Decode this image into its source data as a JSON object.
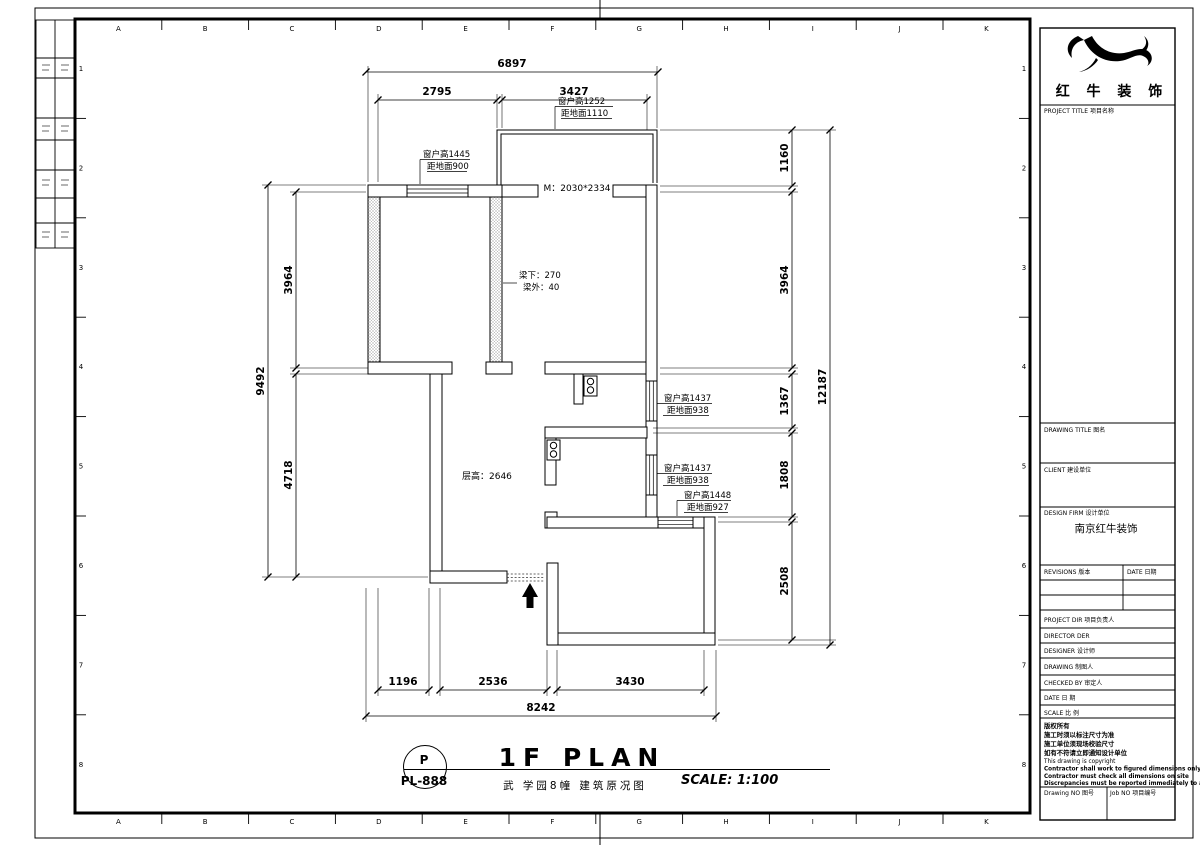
{
  "sheet": {
    "grid": {
      "columns": [
        "A",
        "B",
        "C",
        "D",
        "E",
        "F",
        "G",
        "H",
        "I",
        "J",
        "K"
      ],
      "rows": [
        "1",
        "2",
        "3",
        "4",
        "5",
        "6",
        "7",
        "8"
      ]
    }
  },
  "plan": {
    "dimensions": {
      "top_overall": "6897",
      "top_segments": [
        "2795",
        "3427"
      ],
      "left_overall": "9492",
      "left_segments": [
        "3964",
        "4718"
      ],
      "right_overall": "12187",
      "right_segments": [
        "1160",
        "3964",
        "1367",
        "1808",
        "2508"
      ],
      "bottom_overall": "8242",
      "bottom_segments": [
        "1196",
        "2536",
        "3430"
      ]
    },
    "annotations": {
      "window_left": [
        "窗户高1445",
        "距地面900"
      ],
      "window_top": [
        "窗户高1252",
        "距地面1110"
      ],
      "window_right_upper": [
        "窗户高1437",
        "距地面938"
      ],
      "window_right_lower": [
        "窗户高1437",
        "距地面938"
      ],
      "window_bottom": [
        "窗户高1448",
        "距地面927"
      ],
      "door_size": "M：2030*2334",
      "beam_below": "梁下：270",
      "beam_outside": "梁外：40",
      "ceiling_height": "层高：2646"
    }
  },
  "footer": {
    "code_letter": "P",
    "code_number": "PL-888",
    "title": "1F PLAN",
    "subtitle": "武 学园8幢 建筑原况图",
    "scale_text": "SCALE: 1:100"
  },
  "title_block": {
    "company": "红 牛 装 饰",
    "project_title": "PROJECT TITLE  项目名称",
    "drawing_title": "DRAWING TITLE  图名",
    "client": "CLIENT  建设单位",
    "design_firm": "DESIGN FIRM  设计单位",
    "design_firm_value": "南京红牛装饰",
    "revisions": "REVISIONS  版本",
    "date_col": "DATE  日期",
    "project_dir": "PROJECT DIR  项目负责人",
    "director": "DIRECTOR DER",
    "designer": "DESIGNER  设计师",
    "drawing": "DRAWING  制图人",
    "checked_by": "CHECKED BY  审定人",
    "date": "DATE  日 期",
    "scale": "SCALE  比 例",
    "notes": [
      "版权所有",
      "施工时须以标注尺寸为准",
      "施工单位须现场校验尺寸",
      "如有不符请立即通知设计单位",
      "This drawing is copyright",
      "Contractor shall work to figured dimensions only",
      "Contractor must check all dimensions on site",
      "Discrepancies must be reported immediately to architects"
    ],
    "drawing_no": "Drawing NO  图号",
    "job_no": "Job NO  项目编号"
  }
}
